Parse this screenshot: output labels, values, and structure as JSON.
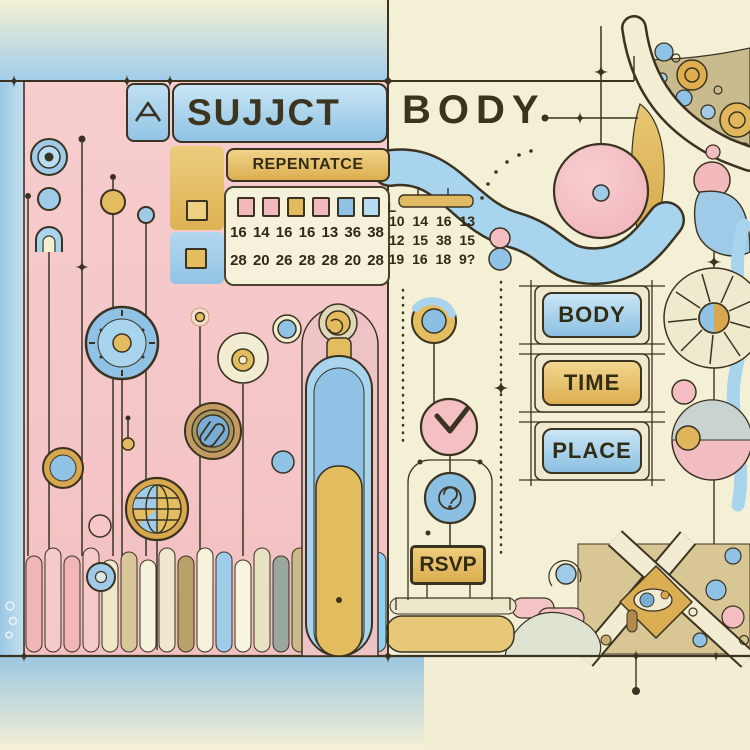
{
  "palette": {
    "cream": "#f4f0d5",
    "pink": "#f5c9ca",
    "blue": "#a9d4ee",
    "blue_deep": "#8fc2e4",
    "yellow": "#e4bd60",
    "gold": "#d9a84e",
    "tan": "#c9bb8e",
    "ink": "#3a3322"
  },
  "header": {
    "subject_label": "SUJJCT",
    "body_label": "BODY"
  },
  "subject_section": {
    "repentance_label": "REPENTATCE",
    "calendar": {
      "day_squares": [
        "pink",
        "pink",
        "yellow",
        "pink",
        "blue",
        "lightblue"
      ],
      "trailing_glyph": "L",
      "number_rows": [
        "16 14 16 16 13 36 38",
        "28 20 26 28 28 20 28"
      ]
    }
  },
  "body_section": {
    "mini_calendar": {
      "number_rows": [
        "10 14 16 13",
        "12 15 38 15",
        "19 16 18 9?"
      ]
    },
    "buttons": [
      {
        "label": "BODY",
        "color": "blue"
      },
      {
        "label": "TIME",
        "color": "yellow"
      },
      {
        "label": "PLACE",
        "color": "blue"
      }
    ],
    "rsvp_label": "RSVP"
  },
  "icons": {
    "home-icon": "⌂",
    "check-icon": "✓",
    "question-icon": "?",
    "paperclip-icon": "📎",
    "globe-icon": "🌐",
    "clock-icon": "🕑",
    "coil-icon": "@",
    "target-icon": "◎",
    "dial-icon": "◉",
    "magnet-icon": "∩"
  }
}
